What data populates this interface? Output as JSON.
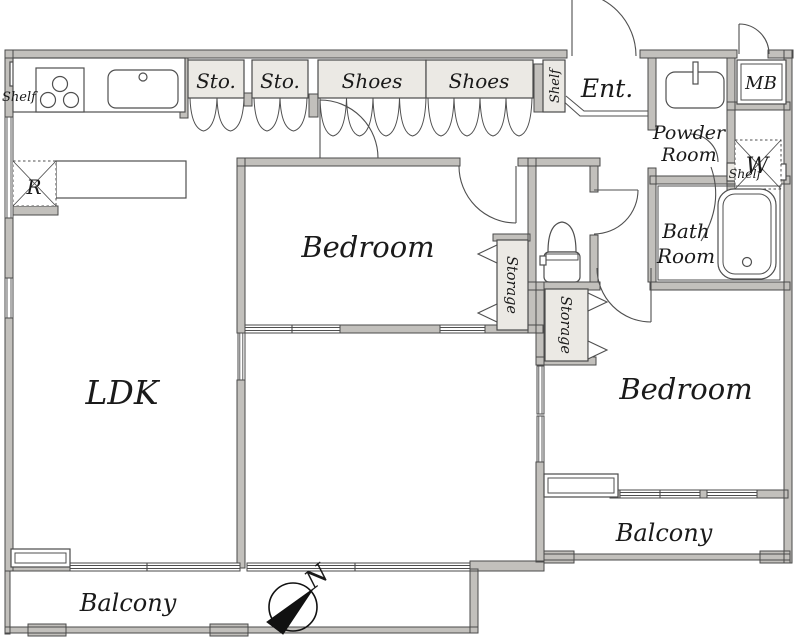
{
  "title": "Apartment floor plan 2LDK",
  "colors": {
    "wall": "#c2c0bc",
    "wallStroke": "#4a4a4a",
    "cabinet": "#ebe9e4",
    "line": "#4f4f4f",
    "text": "#1a1a1a",
    "bg": "#ffffff",
    "needle": "#111111"
  },
  "rooms": {
    "ldk": "LDK",
    "bedroom1": "Bedroom",
    "bedroom2": "Bedroom",
    "balcony_left": "Balcony",
    "balcony_right": "Balcony",
    "entrance": "Ent.",
    "powder_line1": "Powder",
    "powder_line2": "Room",
    "bath_line1": "Bath",
    "bath_line2": "Room"
  },
  "cabinets": {
    "sto1": "Sto.",
    "sto2": "Sto.",
    "shoes1": "Shoes",
    "shoes2": "Shoes",
    "storage1": "Storage",
    "storage2": "Storage",
    "shelf_kitchen": "Shelf",
    "shelf_entrance": "Shelf",
    "shelf_bath": "Shelf"
  },
  "fixtures": {
    "meter_box": "MB",
    "washer": "W",
    "refrigerator": "R"
  },
  "compass": {
    "north": "N"
  }
}
